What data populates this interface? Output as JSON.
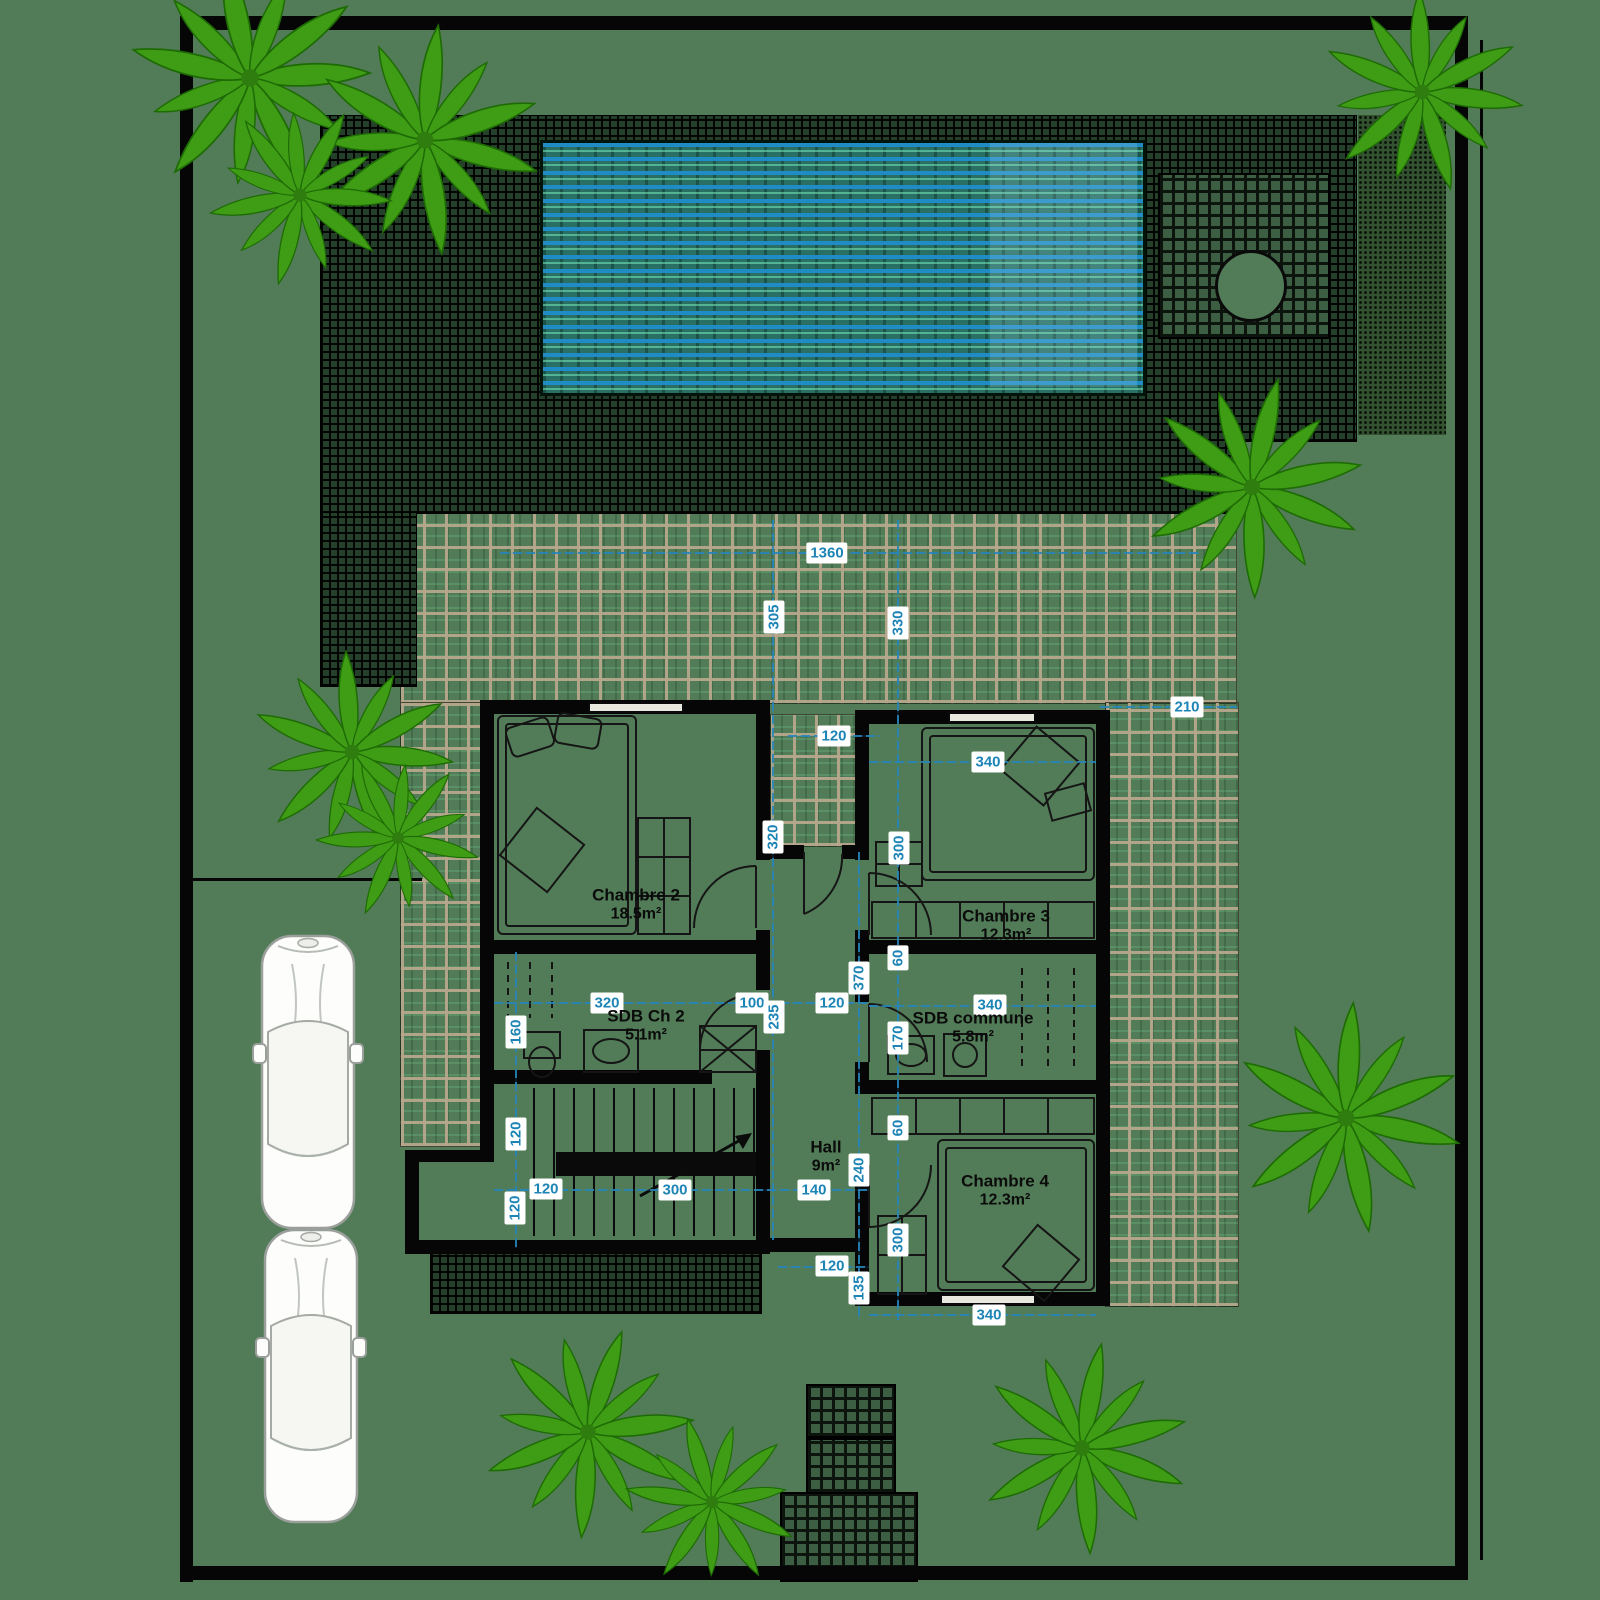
{
  "plan": {
    "title": "villa-floor-plan",
    "rooms": [
      {
        "id": "chambre-2",
        "name": "Chambre 2",
        "area": "18.5m²",
        "x": 636,
        "y": 905
      },
      {
        "id": "sdb-ch2",
        "name": "SDB Ch 2",
        "area": "5.1m²",
        "x": 646,
        "y": 1026
      },
      {
        "id": "chambre-3",
        "name": "Chambre 3",
        "area": "12.3m²",
        "x": 1006,
        "y": 926
      },
      {
        "id": "sdb-commune",
        "name": "SDB commune",
        "area": "5.8m²",
        "x": 973,
        "y": 1028
      },
      {
        "id": "hall",
        "name": "Hall",
        "area": "9m²",
        "x": 826,
        "y": 1157
      },
      {
        "id": "chambre-4",
        "name": "Chambre 4",
        "area": "12.3m²",
        "x": 1005,
        "y": 1191
      }
    ],
    "dimensions": [
      {
        "value": "1360",
        "orient": "h",
        "x": 827,
        "y": 553
      },
      {
        "value": "305",
        "orient": "v",
        "x": 774,
        "y": 617
      },
      {
        "value": "330",
        "orient": "v",
        "x": 898,
        "y": 623
      },
      {
        "value": "210",
        "orient": "h",
        "x": 1187,
        "y": 707
      },
      {
        "value": "120",
        "orient": "h",
        "x": 834,
        "y": 736
      },
      {
        "value": "340",
        "orient": "h",
        "x": 988,
        "y": 762
      },
      {
        "value": "320",
        "orient": "v",
        "x": 773,
        "y": 837
      },
      {
        "value": "300",
        "orient": "v",
        "x": 899,
        "y": 848
      },
      {
        "value": "320",
        "orient": "h",
        "x": 607,
        "y": 1003
      },
      {
        "value": "100",
        "orient": "h",
        "x": 752,
        "y": 1003
      },
      {
        "value": "120",
        "orient": "h",
        "x": 832,
        "y": 1003
      },
      {
        "value": "235",
        "orient": "v",
        "x": 774,
        "y": 1017
      },
      {
        "value": "160",
        "orient": "v",
        "x": 516,
        "y": 1032
      },
      {
        "value": "370",
        "orient": "v",
        "x": 859,
        "y": 978
      },
      {
        "value": "60",
        "orient": "v",
        "x": 898,
        "y": 958
      },
      {
        "value": "170",
        "orient": "v",
        "x": 898,
        "y": 1038
      },
      {
        "value": "340",
        "orient": "h",
        "x": 990,
        "y": 1005
      },
      {
        "value": "120",
        "orient": "v",
        "x": 516,
        "y": 1134
      },
      {
        "value": "120",
        "orient": "h",
        "x": 546,
        "y": 1189
      },
      {
        "value": "120",
        "orient": "v",
        "x": 515,
        "y": 1208
      },
      {
        "value": "300",
        "orient": "h",
        "x": 675,
        "y": 1190
      },
      {
        "value": "140",
        "orient": "h",
        "x": 814,
        "y": 1190
      },
      {
        "value": "240",
        "orient": "v",
        "x": 859,
        "y": 1170
      },
      {
        "value": "60",
        "orient": "v",
        "x": 898,
        "y": 1128
      },
      {
        "value": "120",
        "orient": "h",
        "x": 832,
        "y": 1266
      },
      {
        "value": "135",
        "orient": "v",
        "x": 859,
        "y": 1288
      },
      {
        "value": "300",
        "orient": "v",
        "x": 898,
        "y": 1240
      },
      {
        "value": "340",
        "orient": "h",
        "x": 989,
        "y": 1315
      }
    ],
    "colors": {
      "background": "#517c57",
      "wall": "#060606",
      "dimension_text": "#1d84b5",
      "dimension_line": "#2585bb",
      "dimension_label_bg": "#ffffff",
      "terrace_grid": "#b5a78c",
      "deck_hatch": "#0b120b",
      "pool_blue": "#209ecd",
      "pool_teal": "#78ebbe",
      "palm_green": "#3f9d15",
      "car_body": "#fdfdfb",
      "room_text": "#0b0b0b"
    }
  }
}
